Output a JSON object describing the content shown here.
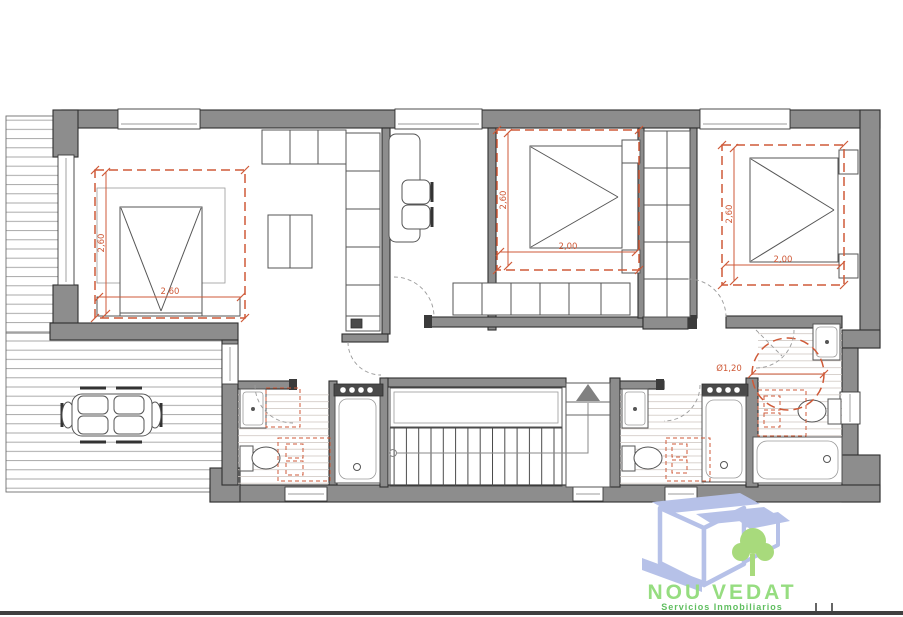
{
  "plan": {
    "bedroom_left": {
      "dim_vertical": "2,60",
      "dim_horizontal": "2,60"
    },
    "bedroom_middle": {
      "dim_vertical": "2,60",
      "dim_horizontal": "2,00"
    },
    "bedroom_right": {
      "dim_vertical": "2,60",
      "dim_horizontal": "2,00"
    },
    "bathroom_right": {
      "turning_circle_diameter": "Ø1,20"
    },
    "colors": {
      "wall_fill": "#8d8d8d",
      "wall_outline": "#2f2f2f",
      "annotation_red": "#cf5a38",
      "tile_line": "#cfc7c2",
      "deck_line": "#a0a0a0"
    }
  },
  "logo": {
    "title": "NOU VEDAT",
    "subtitle": "Servicios Inmobiliarios",
    "colors": {
      "title_green": "#96dd80",
      "subtitle_green": "#5fbe5f",
      "house_periwinkle": "#b6c1e8",
      "tree_green": "#a8da7c"
    }
  }
}
